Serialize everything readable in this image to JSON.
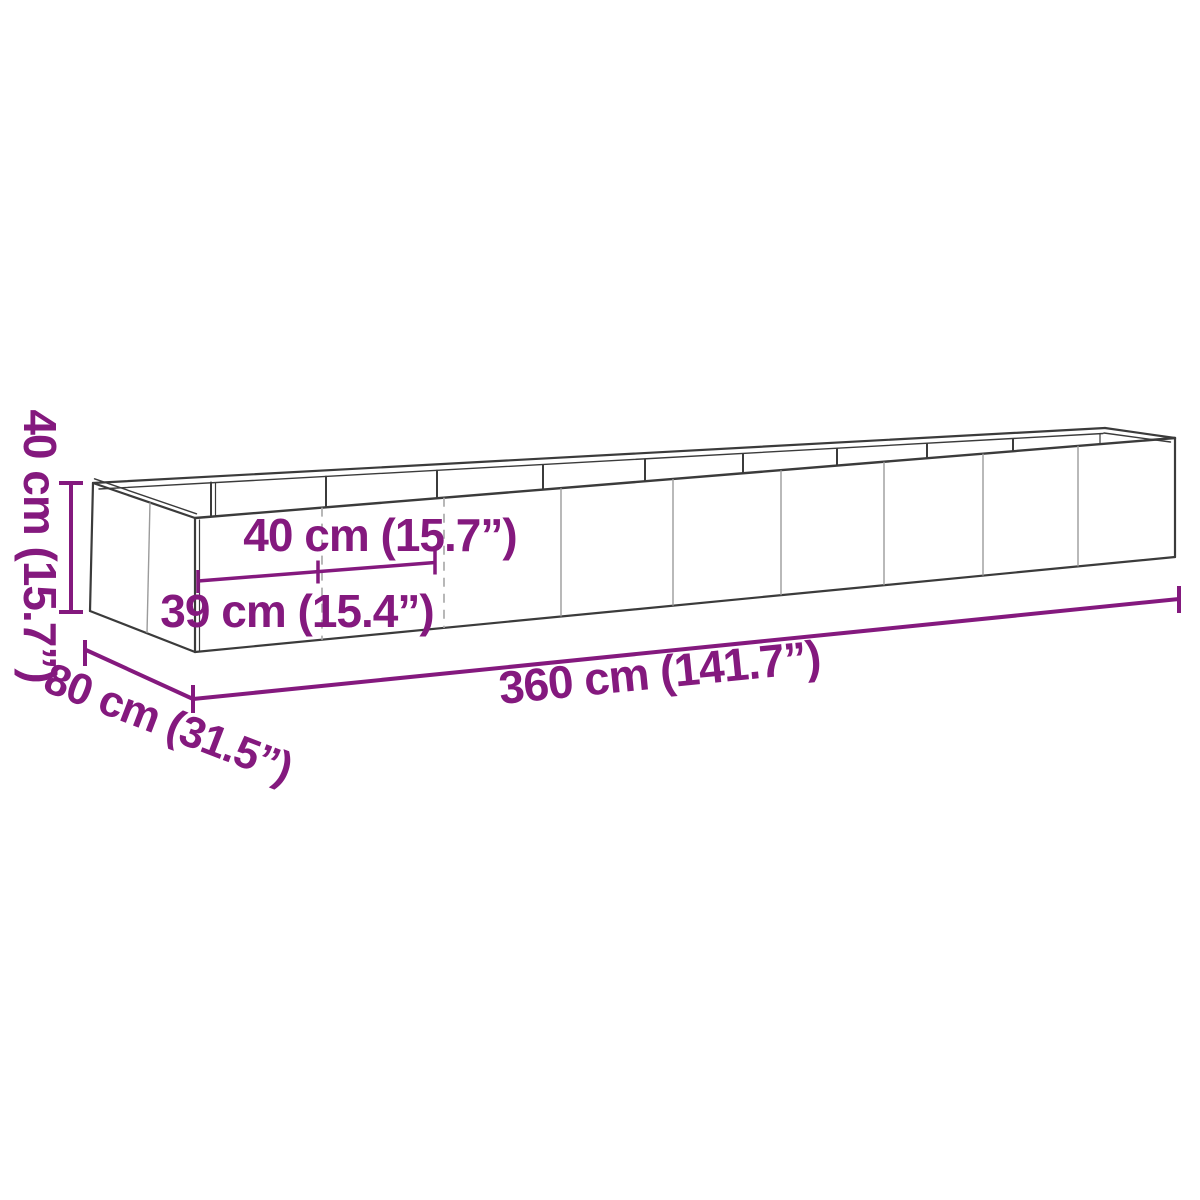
{
  "colors": {
    "background": "#ffffff",
    "dimension": "#84197E",
    "wireframe_dark": "#3b3b3b",
    "wireframe_seam": "#9b9b9b",
    "wireframe_seam_dashed": "#ababab"
  },
  "dimensions": {
    "height_label": "40 cm (15.7”)",
    "depth_label": "80 cm (31.5”)",
    "length_label": "360 cm (141.7”)",
    "panel_width_label": "40 cm (15.7”)",
    "end_panel_width_label": "39 cm (15.4”)"
  }
}
